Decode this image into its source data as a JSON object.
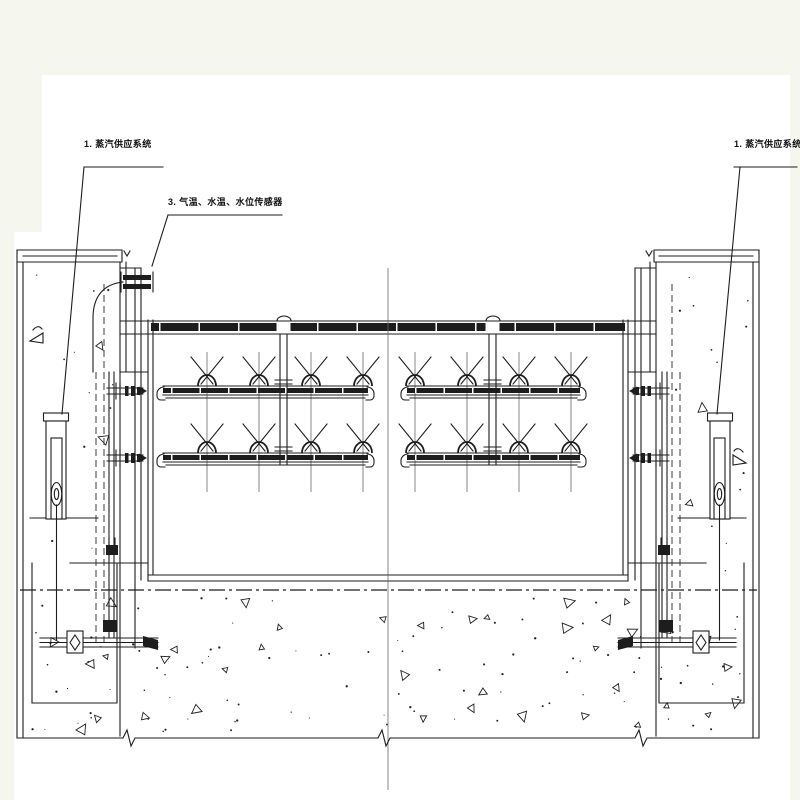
{
  "drawing": {
    "type": "engineering-cad-section",
    "labels": {
      "steam_supply_left": "1. 蒸汽供应系统",
      "sensors": "3. 气温、水温、水位传感器",
      "steam_supply_right": "1. 蒸汽供应系统"
    },
    "colors": {
      "background": "#f5f7ef",
      "paper": "#ffffff",
      "ink": "#1d1d1d"
    }
  }
}
